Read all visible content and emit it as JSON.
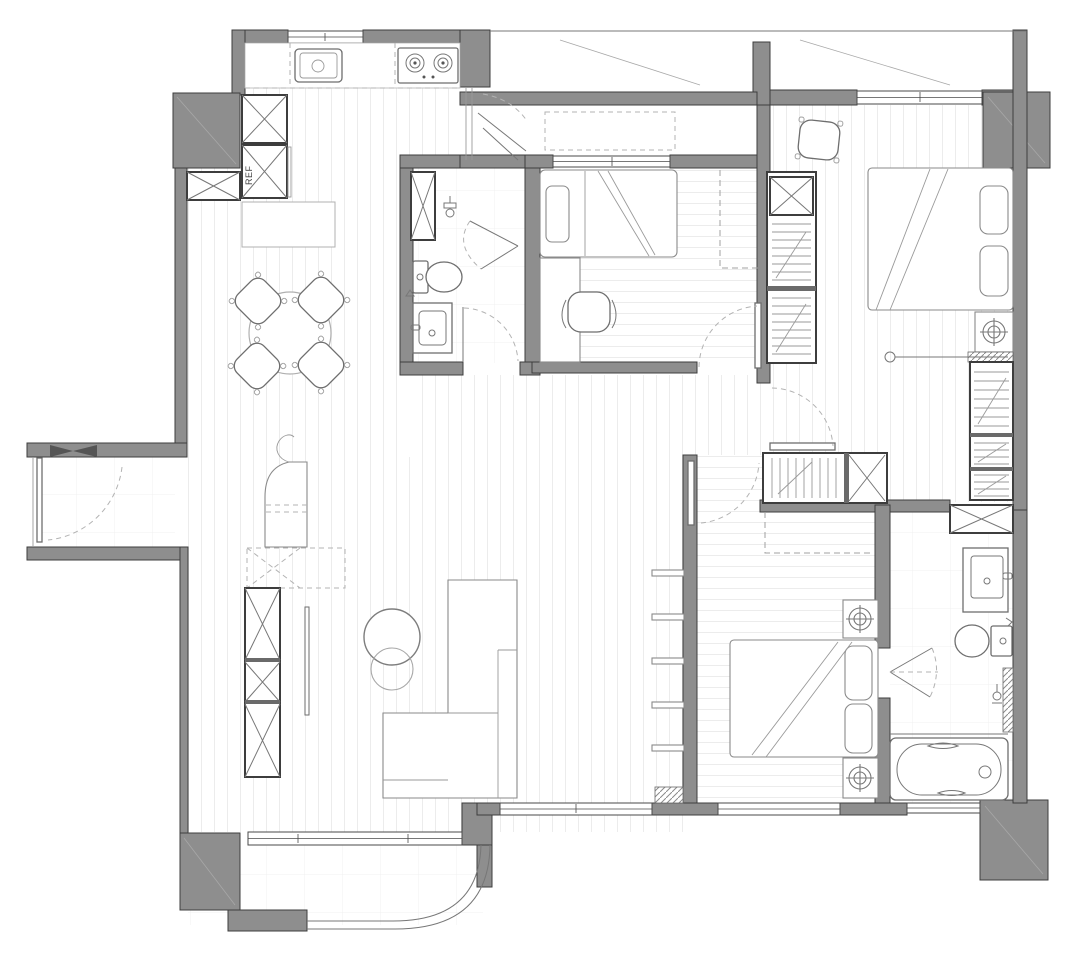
{
  "document": {
    "type": "architectural-floor-plan",
    "style": "black-and-white CAD apartment plan, top-down view",
    "visible_text": [
      "REF"
    ]
  },
  "labels": {
    "refrigerator": "REF"
  },
  "colors": {
    "background": "#ffffff",
    "wall_fill": "#8e8e8e",
    "wall_outline": "#3d3d3d",
    "furniture_line": "#8a8a8a",
    "floor_stripe": "#ececec",
    "tile_line": "#f0f0f0",
    "dashed_line": "#b3b3b3"
  },
  "rooms": [
    {
      "id": "kitchen",
      "name": "Kitchen",
      "furniture": [
        "sink",
        "2-burner stove",
        "counter",
        "tall cabinet",
        "refrigerator cabinet (REF)",
        "island counter",
        "bi-fold balcony door"
      ]
    },
    {
      "id": "dining-area",
      "name": "Dining area",
      "furniture": [
        "round dining table",
        "4 chairs"
      ]
    },
    {
      "id": "entry",
      "name": "Entry",
      "furniture": [
        "entry door with swing arc",
        "side cabinet"
      ]
    },
    {
      "id": "living-room",
      "name": "Living room",
      "furniture": [
        "TV cabinet with X cells",
        "TV",
        "curved console",
        "2 round coffee tables",
        "L-shaped sofa",
        "wall shelves"
      ]
    },
    {
      "id": "bathroom-1",
      "name": "Bathroom (center)",
      "furniture": [
        "storage cabinet",
        "shower folding door",
        "shower fixture",
        "toilet",
        "vanity sink"
      ]
    },
    {
      "id": "bedroom-1",
      "name": "Bedroom (center, single)",
      "furniture": [
        "single bed with pillow",
        "desk",
        "office chair",
        "overhead cabinet (dashed)"
      ]
    },
    {
      "id": "master-bedroom",
      "name": "Master bedroom (top right)",
      "furniture": [
        "double bed with 2 pillows",
        "floor cushion chair",
        "wardrobe with hanging rails",
        "vanity table",
        "tall cabinet with rails",
        "curtain track"
      ]
    },
    {
      "id": "bedroom-2",
      "name": "Bedroom (bottom right)",
      "furniture": [
        "double bed with 2 pillows",
        "2 nightstands with lamps",
        "wardrobe block with hanging rail and X cell"
      ]
    },
    {
      "id": "bathroom-2",
      "name": "Bathroom (bottom right)",
      "furniture": [
        "storage cabinet",
        "vanity sink",
        "toilet",
        "folding door",
        "shower partition",
        "bathtub"
      ]
    },
    {
      "id": "laundry-corridor",
      "name": "Service corridor behind kitchen",
      "furniture": [
        "appliance zone (dashed)"
      ]
    },
    {
      "id": "balcony-top",
      "name": "Top balcony strip",
      "furniture": []
    },
    {
      "id": "balcony-bottom",
      "name": "Bottom balcony with curved railing",
      "furniture": []
    }
  ]
}
